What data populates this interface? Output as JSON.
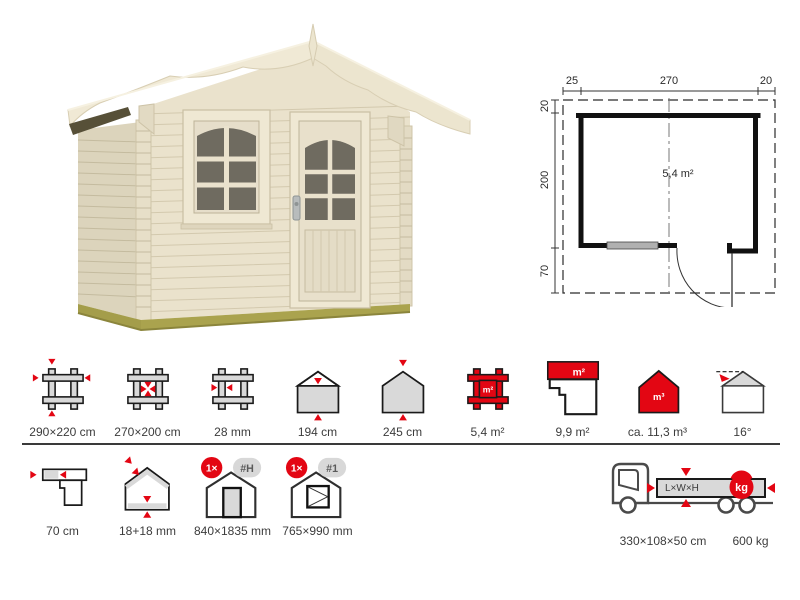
{
  "floor_plan": {
    "top_dimensions": [
      "25",
      "270",
      "20"
    ],
    "left_dimensions": [
      "20",
      "200",
      "70"
    ],
    "area": "5,4 m²"
  },
  "specs_row1": [
    {
      "icon": "external-dimensions",
      "label": "290×220 cm"
    },
    {
      "icon": "internal-dimensions",
      "label": "270×200 cm"
    },
    {
      "icon": "wall-thickness",
      "label": "28 mm"
    },
    {
      "icon": "side-wall-height",
      "label": "194 cm"
    },
    {
      "icon": "ridge-height",
      "label": "245 cm"
    },
    {
      "icon": "floor-area",
      "label": "5,4 m²"
    },
    {
      "icon": "roof-area",
      "label": "9,9 m²"
    },
    {
      "icon": "volume",
      "label": "ca. 11,3 m³"
    },
    {
      "icon": "roof-pitch",
      "label": "16°"
    }
  ],
  "specs_row2": [
    {
      "icon": "roof-overhang",
      "label": "70 cm"
    },
    {
      "icon": "roof-floor-thickness",
      "label": "18+18 mm"
    },
    {
      "icon": "door-size",
      "label": "840×1835 mm",
      "count": "1×",
      "ref": "#H"
    },
    {
      "icon": "window-size",
      "label": "765×990 mm",
      "count": "1×",
      "ref": "#1"
    }
  ],
  "icon_texts": {
    "square_meters": "m²",
    "cubic_meters": "m³"
  },
  "shipping": {
    "cargo_text": "L×W×H",
    "weight_unit": "kg",
    "dimensions": "330×108×50 cm",
    "weight": "600 kg"
  },
  "colors": {
    "accent_red": "#e30613",
    "icon_gray": "#d9d9d9",
    "wall_cream": "#eae2cc",
    "glass_dark": "#6f6b60",
    "foundation_olive": "#a8a24c"
  }
}
